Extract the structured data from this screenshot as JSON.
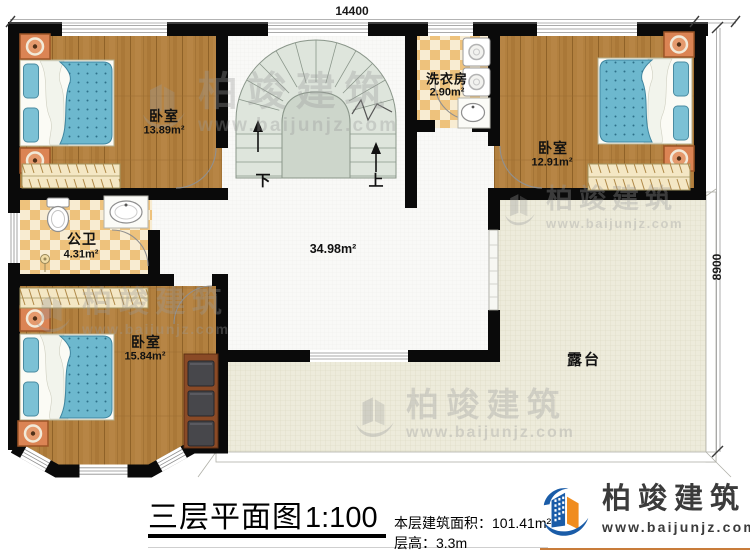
{
  "plan": {
    "dimensions": {
      "top": "14400",
      "right": "8900"
    },
    "stairs": {
      "down": "下",
      "up": "上"
    },
    "rooms": {
      "bedroom1": {
        "name": "卧室",
        "area": "13.89m²"
      },
      "bathroom": {
        "name": "公卫",
        "area": "4.31m²"
      },
      "bedroom3": {
        "name": "卧室",
        "area": "15.84m²"
      },
      "laundry": {
        "name": "洗衣房",
        "area": "2.90m²"
      },
      "bedroom2": {
        "name": "卧室",
        "area": "12.91m²"
      },
      "hall": {
        "area": "34.98m²"
      },
      "terrace": {
        "name": "露台"
      }
    }
  },
  "footer": {
    "title": "三层平面图",
    "scale": "1:100",
    "area_label": "本层建筑面积：",
    "area_value": "101.41m²",
    "height_label": "层高：",
    "height_value": "3.3m"
  },
  "brand": {
    "name": "柏竣建筑",
    "url": "www.baijunjz.com"
  },
  "watermark": {
    "name": "柏竣建筑",
    "url": "www.baijunjz.com"
  },
  "colors": {
    "wall": "#0a0a0a",
    "wood": "#b2803f",
    "tile": "#eec27c",
    "terrace": "#edebdb",
    "stair": "#dee5dc",
    "bed": "#6db8ce",
    "brand_blue": "#1a5ca8",
    "brand_orange": "#f08c1e"
  }
}
